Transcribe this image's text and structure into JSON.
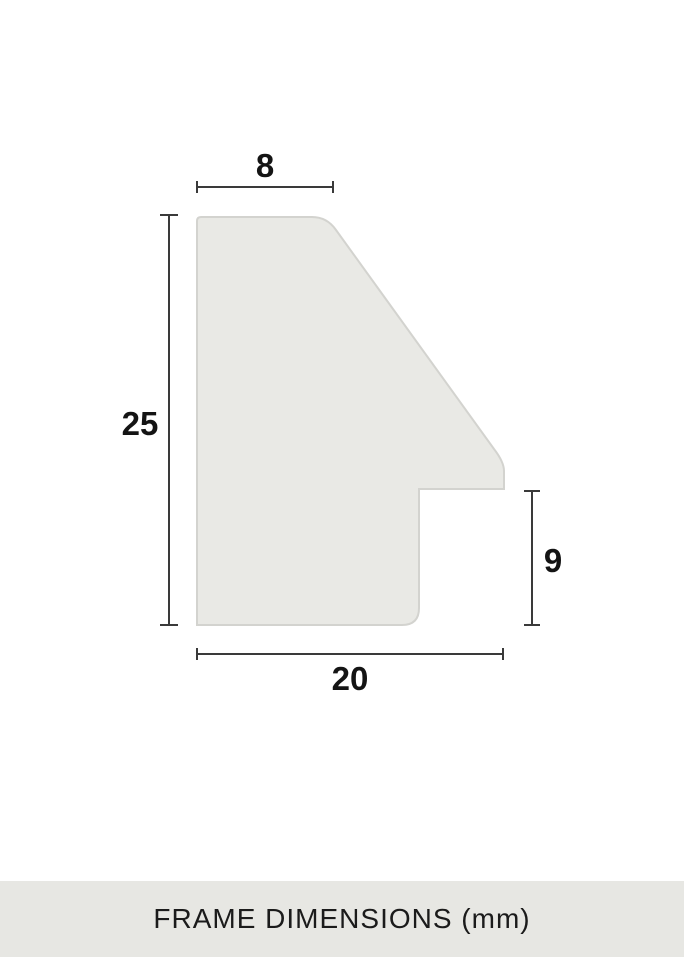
{
  "diagram": {
    "title": "frame moulding profile cross-section",
    "unit": "mm",
    "dimensions": {
      "top_width": "8",
      "left_height": "25",
      "right_height": "9",
      "bottom_width": "20"
    }
  },
  "caption": {
    "text": "FRAME DIMENSIONS (mm)"
  },
  "colors": {
    "background": "#ffffff",
    "profile_fill": "#e9e9e5",
    "profile_stroke": "#d3d3cf",
    "dimension_line": "#3a3a3a",
    "label_text": "#141414",
    "caption_bg": "#e7e7e3",
    "caption_text": "#1b1b1b"
  }
}
